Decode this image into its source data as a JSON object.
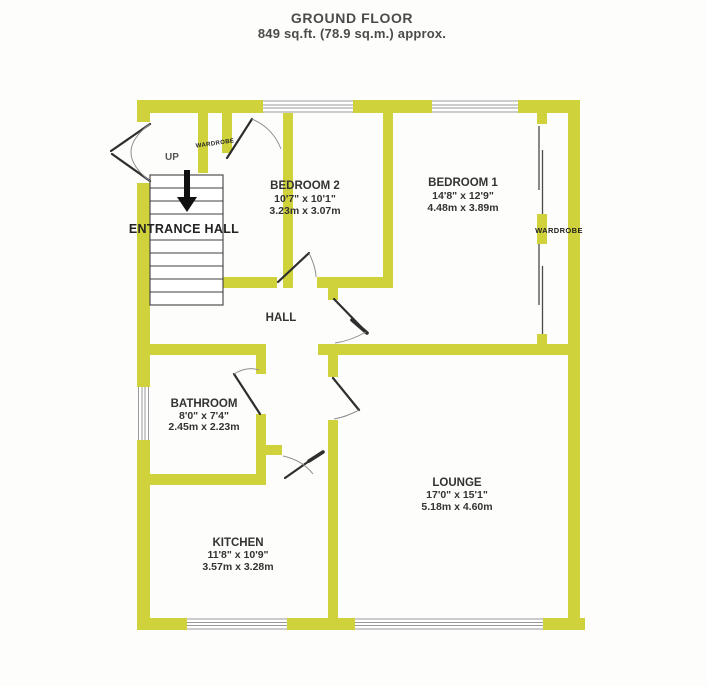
{
  "title": {
    "name": "GROUND FLOOR",
    "area": "849 sq.ft. (78.9 sq.m.) approx."
  },
  "rooms": {
    "bedroom2": {
      "name": "BEDROOM 2",
      "imperial": "10'7\" x 10'1\"",
      "metric": "3.23m x 3.07m"
    },
    "bedroom1": {
      "name": "BEDROOM 1",
      "imperial": "14'8\" x 12'9\"",
      "metric": "4.48m x 3.89m"
    },
    "bathroom": {
      "name": "BATHROOM",
      "imperial": "8'0\" x 7'4\"",
      "metric": "2.45m x 2.23m"
    },
    "kitchen": {
      "name": "KITCHEN",
      "imperial": "11'8\" x 10'9\"",
      "metric": "3.57m x 3.28m"
    },
    "lounge": {
      "name": "LOUNGE",
      "imperial": "17'0\" x 15'1\"",
      "metric": "5.18m x 4.60m"
    },
    "hall": {
      "name": "HALL"
    },
    "entrance_hall": {
      "name": "ENTRANCE HALL"
    }
  },
  "annotations": {
    "up": "UP",
    "wardrobe_left": "WARDROBE",
    "wardrobe_right": "WARDROBE"
  },
  "colors": {
    "wall": "#d0d23b",
    "background": "#fdfdfb"
  }
}
